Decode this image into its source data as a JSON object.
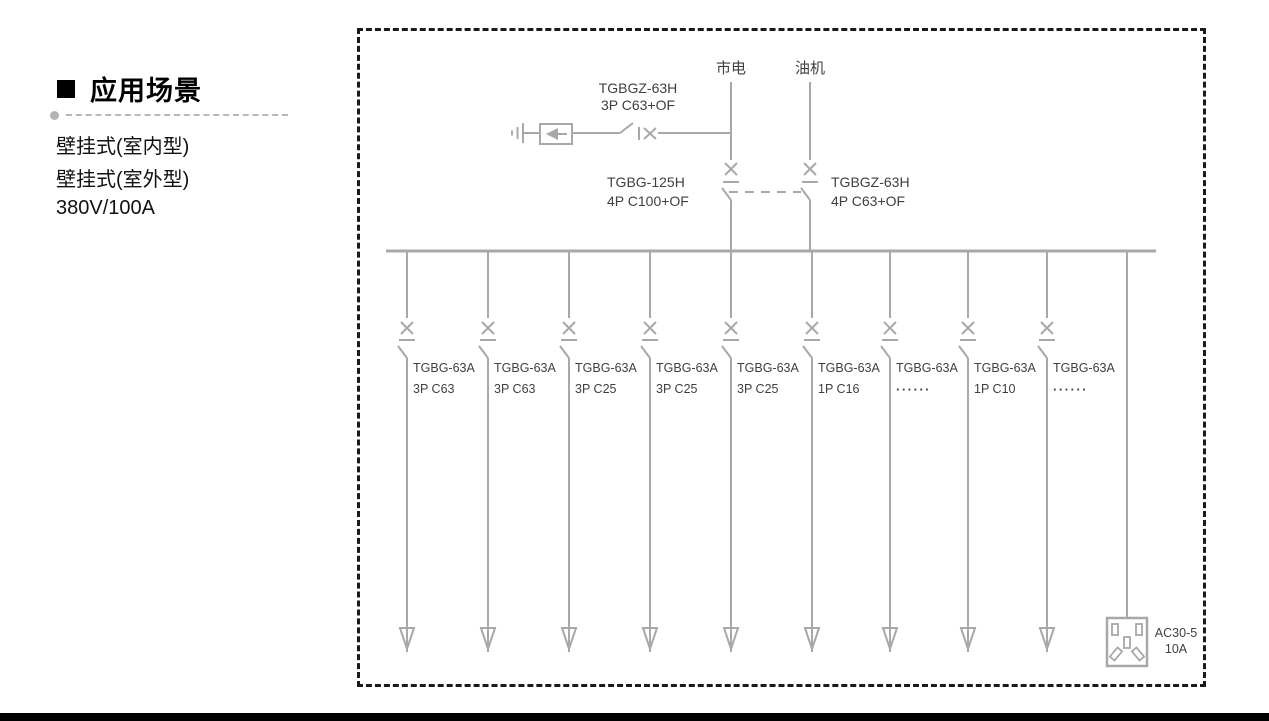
{
  "sidebar": {
    "heading": "应用场景",
    "items": [
      "壁挂式(室内型)",
      "壁挂式(室外型)",
      "380V/100A"
    ]
  },
  "diagram": {
    "sources": [
      {
        "label": "市电"
      },
      {
        "label": "油机"
      }
    ],
    "spd_breaker": {
      "model": "TGBGZ-63H",
      "spec": "3P C63+OF"
    },
    "main_breaker": {
      "model": "TGBG-125H",
      "spec": "4P C100+OF"
    },
    "generator_breaker": {
      "model": "TGBGZ-63H",
      "spec": "4P C63+OF"
    },
    "branches": [
      {
        "model": "TGBG-63A",
        "spec": "3P C63"
      },
      {
        "model": "TGBG-63A",
        "spec": "3P C63"
      },
      {
        "model": "TGBG-63A",
        "spec": "3P C25"
      },
      {
        "model": "TGBG-63A",
        "spec": "3P C25"
      },
      {
        "model": "TGBG-63A",
        "spec": "3P C25"
      },
      {
        "model": "TGBG-63A",
        "spec": "1P C16"
      },
      {
        "model": "TGBG-63A",
        "spec": "······"
      },
      {
        "model": "TGBG-63A",
        "spec": "1P C10"
      },
      {
        "model": "TGBG-63A",
        "spec": "······"
      }
    ],
    "socket": {
      "model": "AC30-5",
      "rating": "10A"
    }
  },
  "colors": {
    "diagram_line": "#a8a8a8",
    "diagram_text": "#3f3f3f",
    "frame_dash": "#1a1a1a",
    "bottom_bar": "#000000"
  }
}
